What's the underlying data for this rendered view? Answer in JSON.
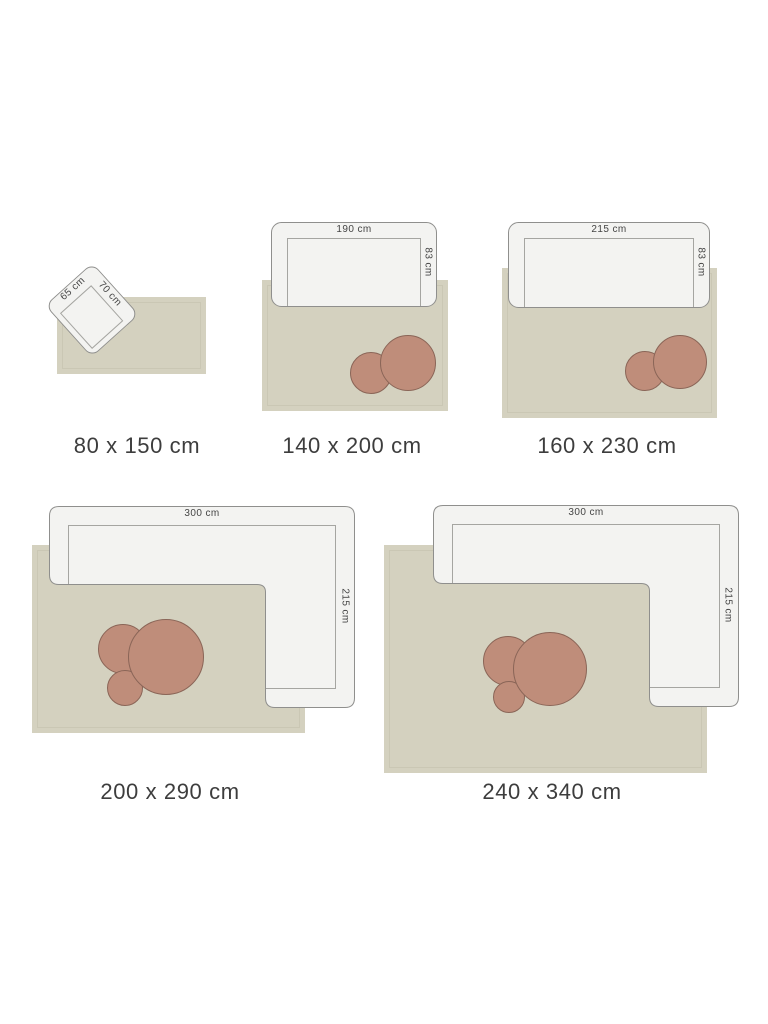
{
  "diagram": "rug-size-guide",
  "colors": {
    "background": "#ffffff",
    "rug": "#d4d1bf",
    "furniture_fill": "#f3f3f1",
    "furniture_border": "#8f8f8d",
    "furniture_inner_line": "#a5a5a1",
    "table_fill": "#bf8d7a",
    "table_border": "#8a6557",
    "text": "#3d3d3d"
  },
  "panels": [
    {
      "id": "80x150",
      "size_label": "80 x 150 cm",
      "furniture": "armchair",
      "furniture_width_label": "65 cm",
      "furniture_depth_label": "70 cm",
      "tables": 0
    },
    {
      "id": "140x200",
      "size_label": "140 x 200 cm",
      "furniture": "sofa",
      "furniture_width_label": "190 cm",
      "furniture_depth_label": "83 cm",
      "tables": 2
    },
    {
      "id": "160x230",
      "size_label": "160 x 230 cm",
      "furniture": "sofa",
      "furniture_width_label": "215 cm",
      "furniture_depth_label": "83 cm",
      "tables": 2
    },
    {
      "id": "200x290",
      "size_label": "200 x 290 cm",
      "furniture": "corner-sofa",
      "furniture_width_label": "300 cm",
      "furniture_depth_label": "215 cm",
      "tables": 3
    },
    {
      "id": "240x340",
      "size_label": "240 x 340 cm",
      "furniture": "corner-sofa",
      "furniture_width_label": "300 cm",
      "furniture_depth_label": "215 cm",
      "tables": 3
    }
  ]
}
